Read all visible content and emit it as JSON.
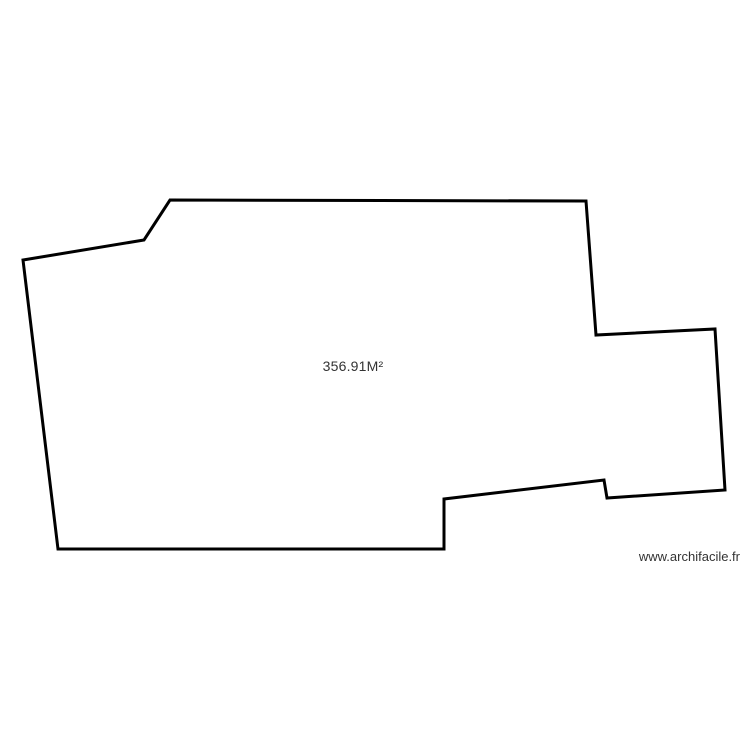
{
  "plan": {
    "area_label": "356.91M²",
    "outline_color": "#000000",
    "fill_color": "#ffffff",
    "stroke_width": 3,
    "points": [
      [
        170,
        200
      ],
      [
        586,
        201
      ],
      [
        596,
        335
      ],
      [
        715,
        329
      ],
      [
        725,
        490
      ],
      [
        607,
        498
      ],
      [
        604,
        480
      ],
      [
        444,
        499
      ],
      [
        444,
        549
      ],
      [
        58,
        549
      ],
      [
        23,
        260
      ],
      [
        144,
        240
      ]
    ]
  },
  "watermark": {
    "text": "www.archifacile.fr"
  }
}
